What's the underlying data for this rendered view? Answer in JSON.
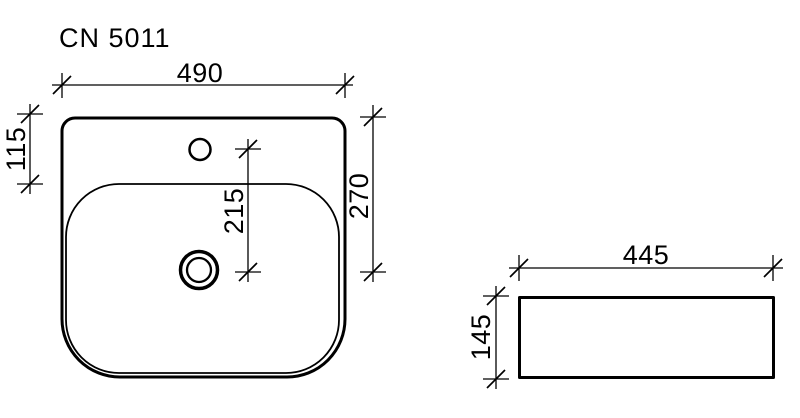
{
  "drawing": {
    "title": "CN 5011",
    "colors": {
      "line": "#000000",
      "background": "#ffffff"
    },
    "top_view": {
      "labels": {
        "overall_width": "490",
        "rim_to_bowl": "115",
        "faucet_to_drain": "215",
        "rim_to_drain": "270"
      }
    },
    "side_view": {
      "labels": {
        "width": "445",
        "height": "145"
      }
    }
  }
}
